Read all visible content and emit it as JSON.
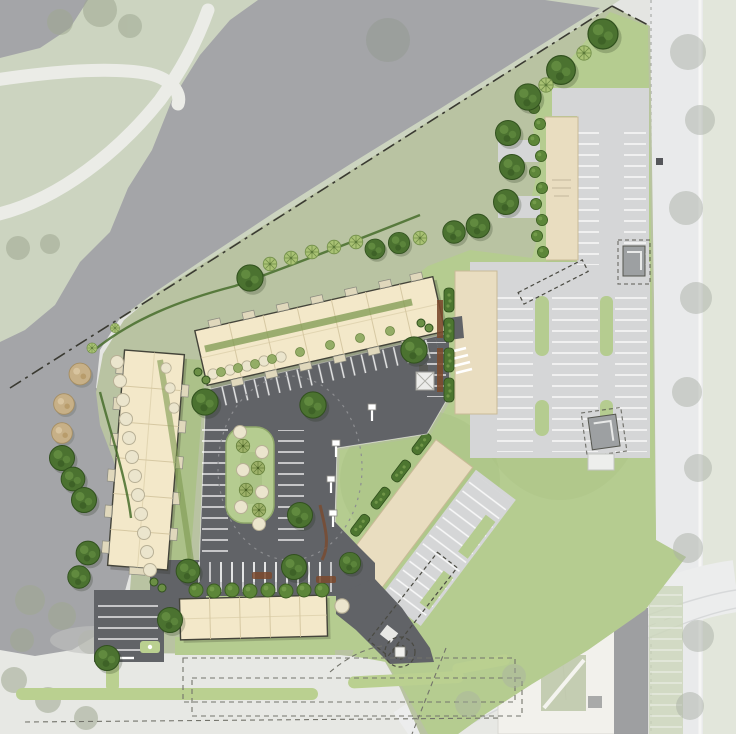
{
  "document": {
    "kind": "architectural site plan rendering, aerial plan view",
    "visible_text": "none (annotation on building pads illegible at scale)"
  },
  "colors": {
    "contextBase": "#e4e5e2",
    "southRoad": "#e7e8e4",
    "roadRight": "#e9eaeb",
    "roadFar": "#e2e6db",
    "golfGreen": "#ccd4c0",
    "golfPath": "#ebece7",
    "water": "#a4a5a8",
    "bufferGreen": "#b9c3a2",
    "lawn": "#b5cc90",
    "lawnOlive": "#a9c083",
    "parkingDark": "#616367",
    "parkingLight": "#d5d6d7",
    "building": "#f3e8c9",
    "buildingLine": "#d6c8a2",
    "buildingEdge": "#44443a",
    "pad": "#e9ddc0",
    "padEdge": "#c9ba97",
    "treeDark": "#4b7230",
    "treeDarkEdge": "#31511e",
    "treeHighlight": "#6f9b49",
    "treeLight": "#a9c274",
    "treeTan": "#c7b087",
    "shrubCream": "#ebe5cd",
    "hedge": "#4d7630",
    "mulch": "#7b4a2e",
    "shed": "#9da0a2",
    "existing": "#f2f1ec",
    "existingRoof": "#8f9194",
    "median": "#bad090",
    "fade": "#aab0a3",
    "stall": "#ffffff",
    "propertyLine": "#3a3a32"
  },
  "summary": {
    "residential_buildings": 3,
    "commercial_building_pads": 3,
    "utility_sheds": 2,
    "ponds": 2,
    "canopy_trees": 27,
    "ornamental_trees": 10,
    "tan_accent_trees": 3,
    "parking_fields": 4,
    "entry_drives": 3,
    "golf_course_adjacent": true,
    "property_line_style": "dash-dot",
    "central_island_trees": 4
  }
}
